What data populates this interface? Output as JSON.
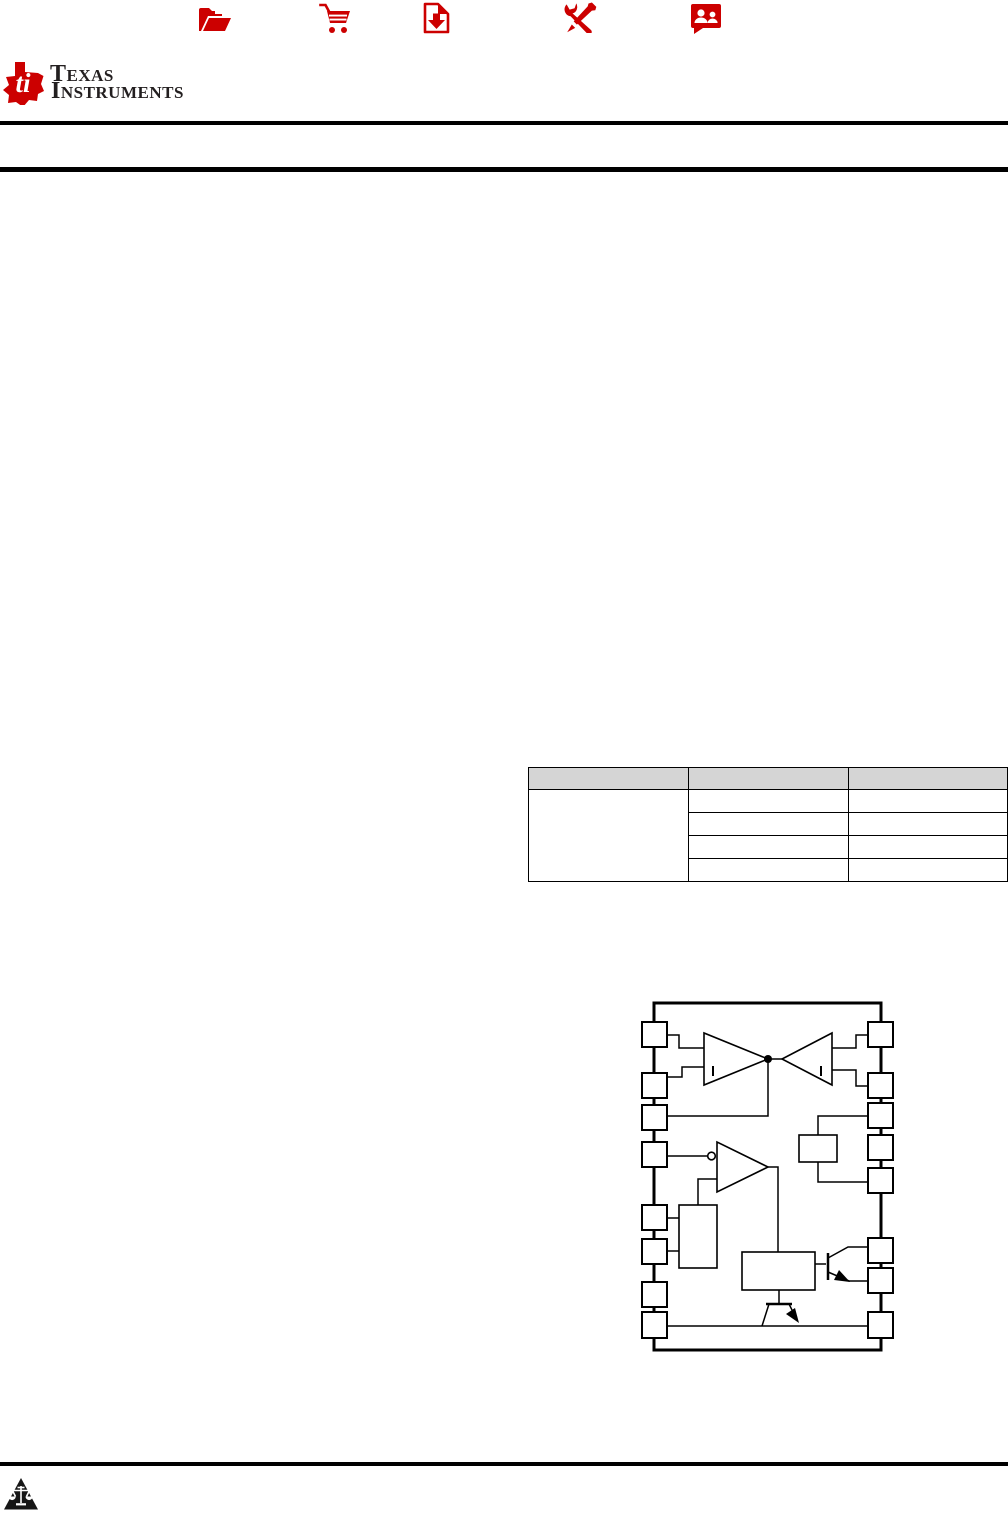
{
  "page": {
    "width": 1008,
    "height": 1513,
    "background": "#ffffff"
  },
  "header": {
    "icon_color": "#cc0000",
    "icons": [
      {
        "name": "product-folder"
      },
      {
        "name": "order-now-cart"
      },
      {
        "name": "technical-documents-download"
      },
      {
        "name": "tools-and-software"
      },
      {
        "name": "support-and-community"
      }
    ],
    "logo": {
      "line1": "Texas",
      "line2": "Instruments",
      "bug_color": "#cc0000",
      "bug_letters": "ti",
      "text_color": "#231f20"
    }
  },
  "horizontal_rules": {
    "count": 3,
    "color": "#000000"
  },
  "device_information_table": {
    "columns": 3,
    "body_rows": 4,
    "first_column_merged": true,
    "header_fill": "#d5d5d5",
    "border_color": "#000000",
    "cells_empty": true
  },
  "functional_block_diagram": {
    "left_pins": 8,
    "right_pins": 8,
    "line_color": "#000000",
    "elements": [
      "comparator-1",
      "comparator-2",
      "comparator-3",
      "inverter-bubble",
      "junction-dot",
      "flip-flop-block",
      "inner-block",
      "output-stage-block",
      "output-transistor",
      "discharge-transistor"
    ]
  },
  "footer": {
    "icon": "scales-of-justice",
    "icon_color": "#161616"
  }
}
